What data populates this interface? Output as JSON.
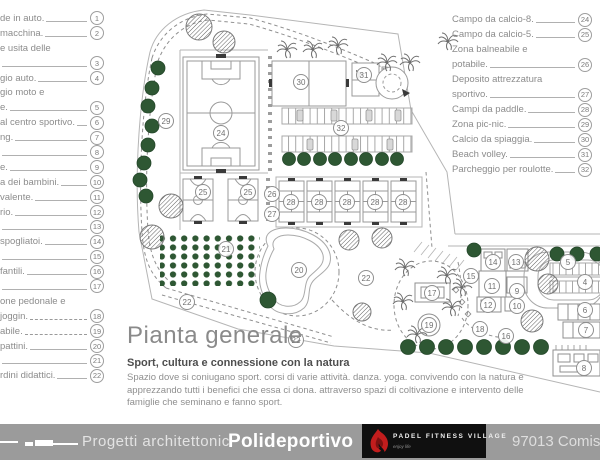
{
  "legend_left": {
    "items": [
      {
        "num": "1",
        "lines": [
          "de in auto."
        ],
        "dashed": false
      },
      {
        "num": "2",
        "lines": [
          "macchina."
        ],
        "dashed": false
      },
      {
        "num": "3",
        "lines": [
          "e usita delle",
          ""
        ],
        "dashed": false
      },
      {
        "num": "4",
        "lines": [
          "gio auto."
        ],
        "dashed": false
      },
      {
        "num": "5",
        "lines": [
          "gio moto e",
          "e."
        ],
        "dashed": false
      },
      {
        "num": "6",
        "lines": [
          "al centro sportivo."
        ],
        "dashed": false
      },
      {
        "num": "7",
        "lines": [
          "ng."
        ],
        "dashed": false
      },
      {
        "num": "8",
        "lines": [
          ""
        ],
        "dashed": false
      },
      {
        "num": "9",
        "lines": [
          "e."
        ],
        "dashed": false
      },
      {
        "num": "10",
        "lines": [
          "a dei bambini."
        ],
        "dashed": false
      },
      {
        "num": "11",
        "lines": [
          "valente."
        ],
        "dashed": false
      },
      {
        "num": "12",
        "lines": [
          "rio."
        ],
        "dashed": false
      },
      {
        "num": "13",
        "lines": [
          ""
        ],
        "dashed": false
      },
      {
        "num": "14",
        "lines": [
          "spogliatoi."
        ],
        "dashed": false
      },
      {
        "num": "15",
        "lines": [
          ""
        ],
        "dashed": false
      },
      {
        "num": "16",
        "lines": [
          "fantili."
        ],
        "dashed": false
      },
      {
        "num": "17",
        "lines": [
          ""
        ],
        "dashed": false
      },
      {
        "num": "18",
        "lines": [
          "one pedonale e",
          "joggin."
        ],
        "dashed": true
      },
      {
        "num": "19",
        "lines": [
          "abile."
        ],
        "dashed": true
      },
      {
        "num": "20",
        "lines": [
          "pattini."
        ],
        "dashed": false
      },
      {
        "num": "21",
        "lines": [
          ""
        ],
        "dashed": false
      },
      {
        "num": "22",
        "lines": [
          "rdini didattici."
        ],
        "dashed": false
      }
    ]
  },
  "legend_right": {
    "items": [
      {
        "num": "24",
        "lines": [
          "Campo da calcio-8."
        ],
        "dashed": false
      },
      {
        "num": "25",
        "lines": [
          "Campo da calcio-5."
        ],
        "dashed": false
      },
      {
        "num": "26",
        "lines": [
          "Zona balneabile e",
          "potabile."
        ],
        "dashed": false
      },
      {
        "num": "27",
        "lines": [
          "Deposito attrezzatura",
          "sportivo."
        ],
        "dashed": false
      },
      {
        "num": "28",
        "lines": [
          "Campi da paddle."
        ],
        "dashed": false
      },
      {
        "num": "29",
        "lines": [
          "Zona pic-nic."
        ],
        "dashed": false
      },
      {
        "num": "30",
        "lines": [
          "Calcio da spiaggia."
        ],
        "dashed": false
      },
      {
        "num": "31",
        "lines": [
          "Beach volley."
        ],
        "dashed": false
      },
      {
        "num": "32",
        "lines": [
          "Parcheggio per roulotte."
        ],
        "dashed": false
      }
    ]
  },
  "plan": {
    "markers": [
      {
        "n": "24",
        "x": 221,
        "y": 133
      },
      {
        "n": "29",
        "x": 166,
        "y": 121
      },
      {
        "n": "30",
        "x": 301,
        "y": 82
      },
      {
        "n": "31",
        "x": 364,
        "y": 75
      },
      {
        "n": "32",
        "x": 341,
        "y": 128
      },
      {
        "n": "25",
        "x": 203,
        "y": 192
      },
      {
        "n": "25",
        "x": 248,
        "y": 192
      },
      {
        "n": "26",
        "x": 272,
        "y": 194
      },
      {
        "n": "27",
        "x": 272,
        "y": 214
      },
      {
        "n": "28",
        "x": 291,
        "y": 202
      },
      {
        "n": "28",
        "x": 319,
        "y": 202
      },
      {
        "n": "28",
        "x": 347,
        "y": 202
      },
      {
        "n": "28",
        "x": 375,
        "y": 202
      },
      {
        "n": "28",
        "x": 403,
        "y": 202
      },
      {
        "n": "21",
        "x": 226,
        "y": 249
      },
      {
        "n": "20",
        "x": 299,
        "y": 270
      },
      {
        "n": "22",
        "x": 187,
        "y": 302
      },
      {
        "n": "22",
        "x": 296,
        "y": 340
      },
      {
        "n": "22",
        "x": 366,
        "y": 278
      },
      {
        "n": "17",
        "x": 432,
        "y": 293
      },
      {
        "n": "19",
        "x": 429,
        "y": 325
      },
      {
        "n": "15",
        "x": 471,
        "y": 276
      },
      {
        "n": "14",
        "x": 493,
        "y": 262
      },
      {
        "n": "13",
        "x": 516,
        "y": 262
      },
      {
        "n": "11",
        "x": 492,
        "y": 286
      },
      {
        "n": "9",
        "x": 517,
        "y": 291
      },
      {
        "n": "10",
        "x": 517,
        "y": 306
      },
      {
        "n": "12",
        "x": 488,
        "y": 305
      },
      {
        "n": "18",
        "x": 480,
        "y": 329
      },
      {
        "n": "16",
        "x": 506,
        "y": 336
      },
      {
        "n": "5",
        "x": 568,
        "y": 262
      },
      {
        "n": "4",
        "x": 585,
        "y": 282
      },
      {
        "n": "6",
        "x": 585,
        "y": 310
      },
      {
        "n": "7",
        "x": 586,
        "y": 330
      },
      {
        "n": "8",
        "x": 584,
        "y": 368
      }
    ]
  },
  "title_block": {
    "title": "Pianta generale",
    "subtitle": "Sport, cultura e connessione con la natura",
    "body": "Spazio dove si coniugano sport. corsi di varie attività. danza. yoga. convivendo con la natura e apprezzando tutti i benefici che essa ci dona. attraverso spazi di coltivazione e intervento delle famiglie che seminano e fanno sport."
  },
  "footer": {
    "left_label": "Progetti architettonici",
    "project_name": "Polideportivo",
    "logo_title": "PADEL FITNESS VILLAGE",
    "logo_tagline": "enjoy life",
    "location": "97013 Comis"
  },
  "colors": {
    "tree_green": "#2e5733",
    "footer_gray": "#9b9b9b",
    "logo_black": "#101010",
    "flame_red": "#c21d1d"
  }
}
